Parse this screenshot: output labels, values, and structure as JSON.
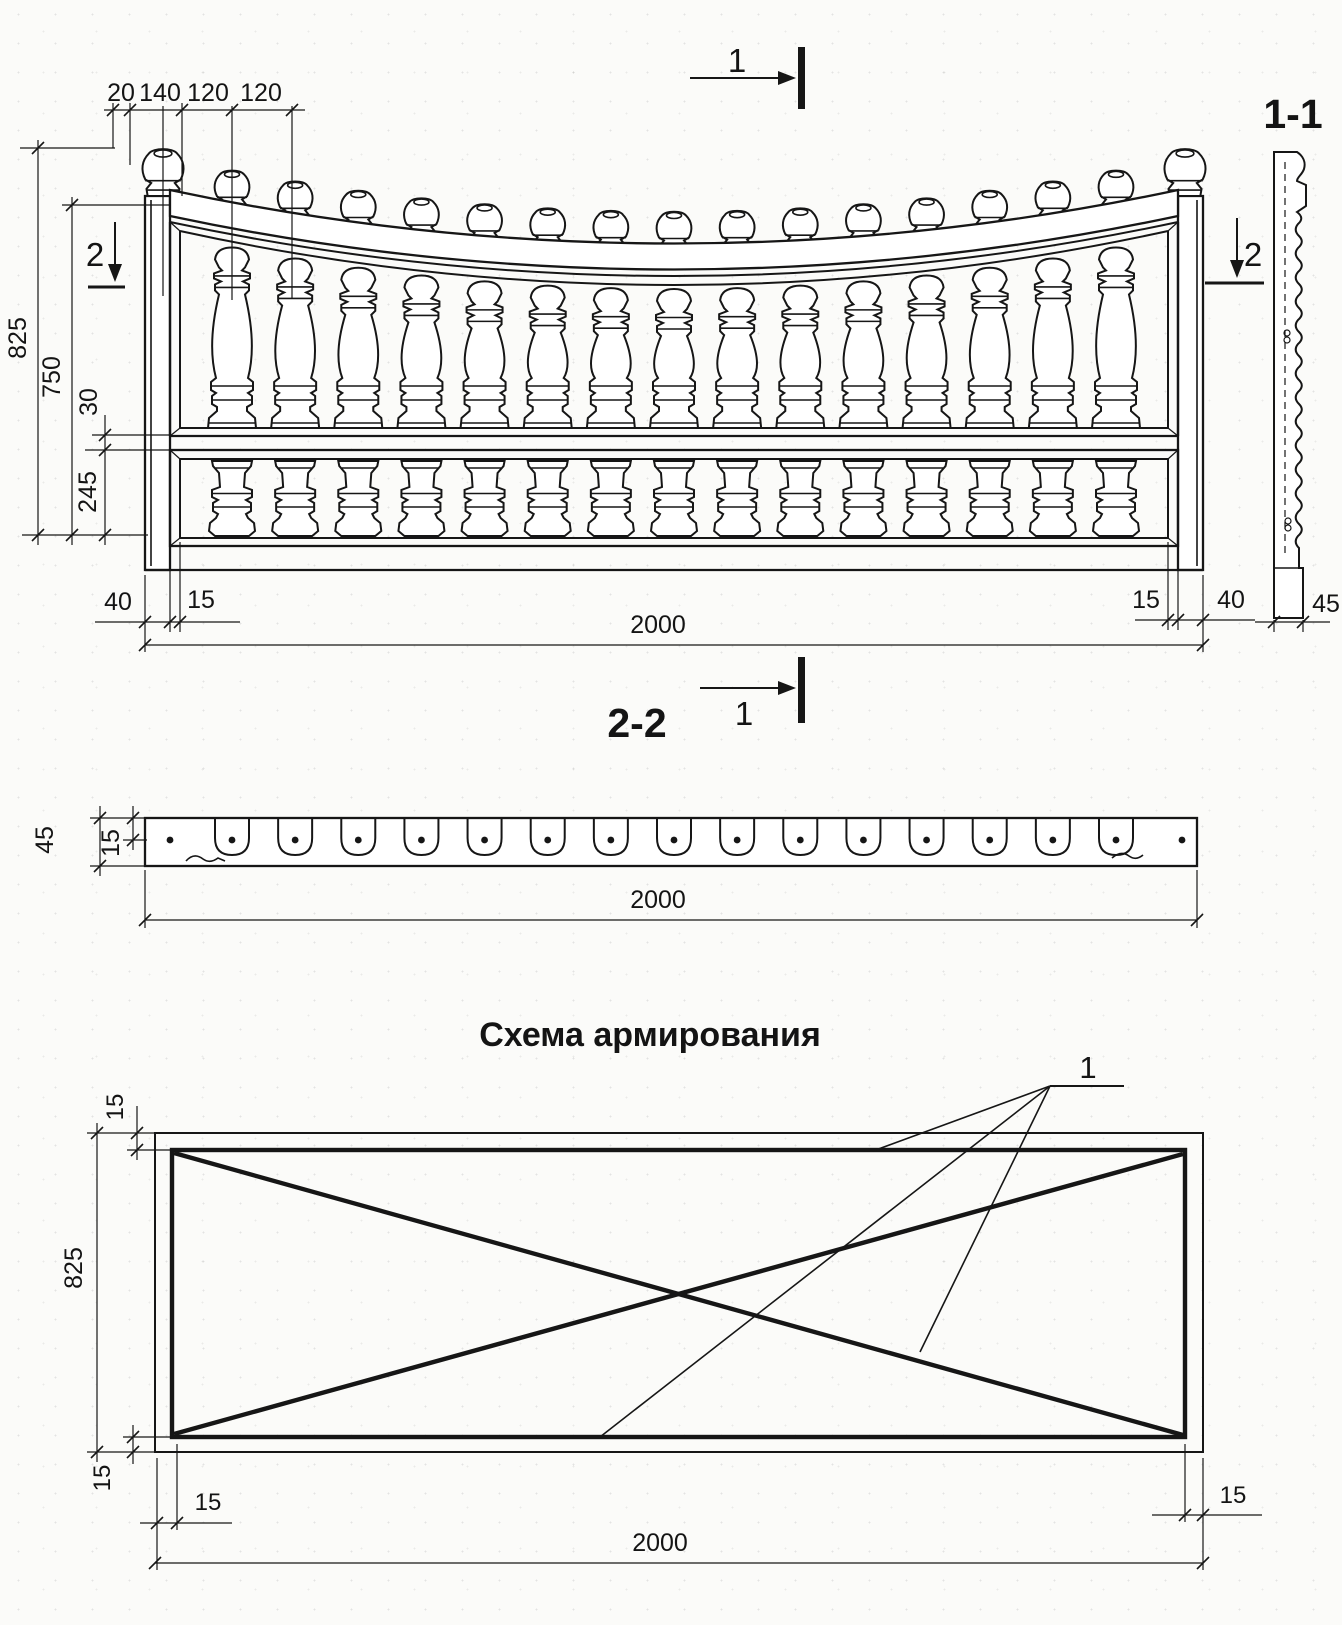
{
  "labels": {
    "section_marker_1": "1",
    "section_marker_2": "2",
    "section_view_11": "1-1",
    "section_view_22": "2-2",
    "reinforcement_title": "Схема армирования",
    "rebar_callout": "1"
  },
  "front_view": {
    "top_dims": [
      "20",
      "140",
      "120",
      "120"
    ],
    "height_total": "825",
    "height_to_rail": "750",
    "rail_gap": "30",
    "lower_panel_height": "245",
    "edge_offset_left": "40",
    "frame_border_left": "15",
    "frame_border_right": "15",
    "edge_offset_right": "40",
    "width_total": "2000",
    "baluster_count": 15
  },
  "section_11": {
    "base_width": "45"
  },
  "section_22": {
    "thickness": "45",
    "cover": "15",
    "width": "2000",
    "hole_count": 15
  },
  "reinforcement_scheme": {
    "height": "825",
    "cover_top": "15",
    "cover_bottom": "15",
    "cover_left": "15",
    "cover_right": "15",
    "width": "2000"
  }
}
